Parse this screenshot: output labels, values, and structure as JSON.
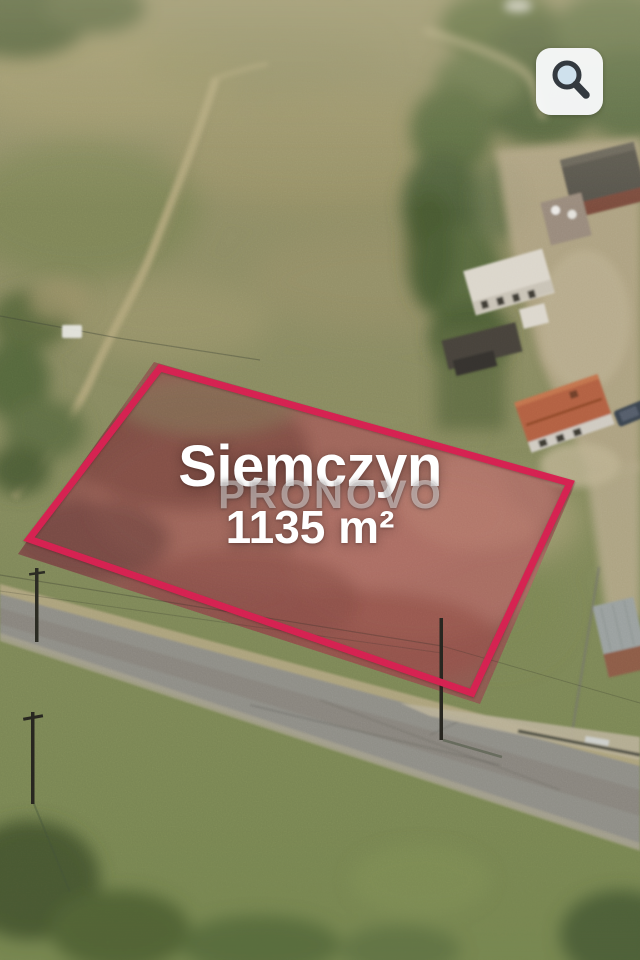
{
  "listing": {
    "location": "Siemczyn",
    "area": "1135 m²"
  },
  "watermark": "PRONOVO",
  "toolbar": {
    "zoom_button_icon": "magnifier"
  },
  "annotation": {
    "plot_outline_color": "#d5214f",
    "plot_outline_corners": [
      [
        160,
        368
      ],
      [
        570,
        483
      ],
      [
        472,
        693
      ],
      [
        29,
        539
      ]
    ]
  },
  "palette": {
    "overlay_text": "#ffffff",
    "watermark_text": "rgba(255,255,255,0.44)",
    "button_background": "#f5f6f7",
    "button_icon": "#343a40",
    "magnifier_lens": "#cfe1ed",
    "field_green": "#8d8c66",
    "heather_pink": "#8d5a50",
    "road_gray": "#8e8d85"
  }
}
